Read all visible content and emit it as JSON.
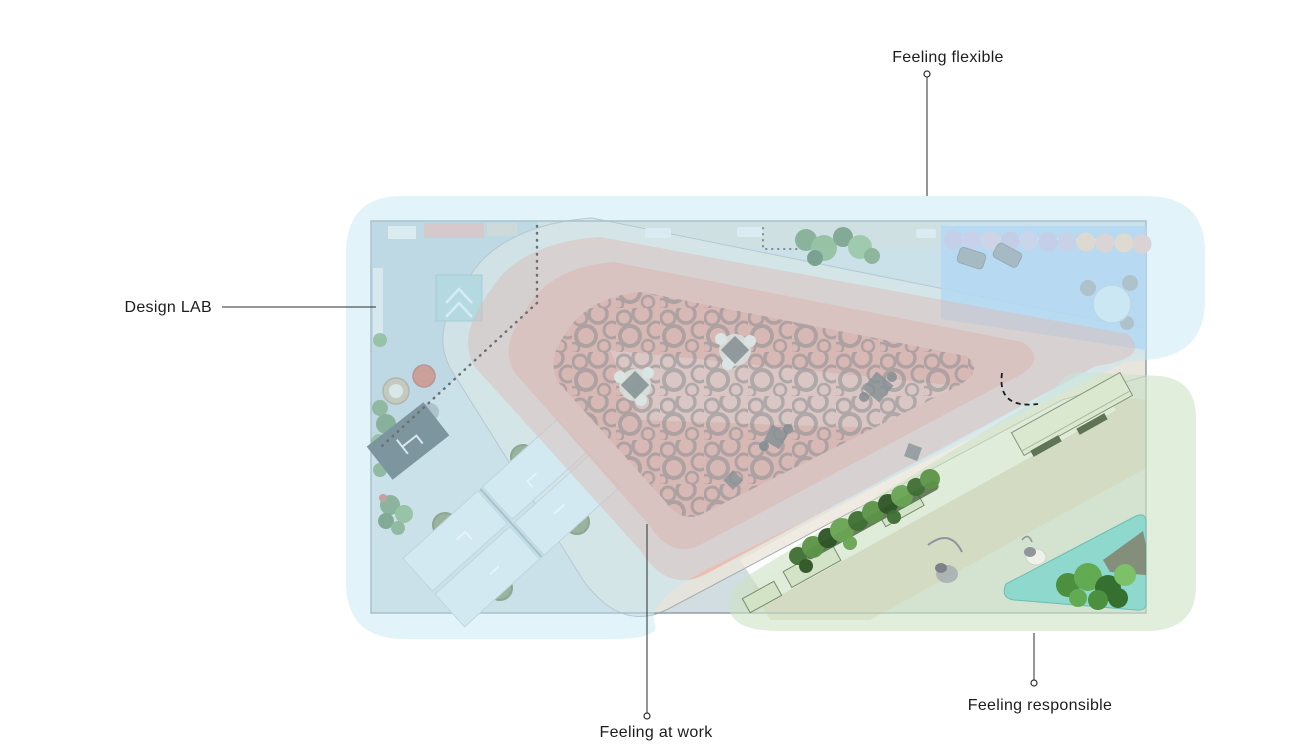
{
  "page": {
    "width": 1314,
    "height": 749,
    "background": "#ffffff",
    "type": "annotated-floor-plan"
  },
  "labels": {
    "flexible": {
      "text": "Feeling flexible"
    },
    "design_lab": {
      "text": "Design LAB"
    },
    "at_work": {
      "text": "Feeling at work"
    },
    "responsible": {
      "text": "Feeling responsible"
    }
  },
  "palette": {
    "zone_flexible": "#c2e5f4",
    "zone_at_work_outer": "#f09a84",
    "zone_at_work_inner": "#ee8a72",
    "rug": "#ea8370",
    "zone_responsible": "#cde2c5",
    "flexible_room": "#a6cef2",
    "planter_teal": "#8bd7cc",
    "track": "#ebe5da",
    "plan_floor": "#d2dde1",
    "lab_floor": "#b9cad4",
    "leader_line": "#2e2e2e"
  }
}
